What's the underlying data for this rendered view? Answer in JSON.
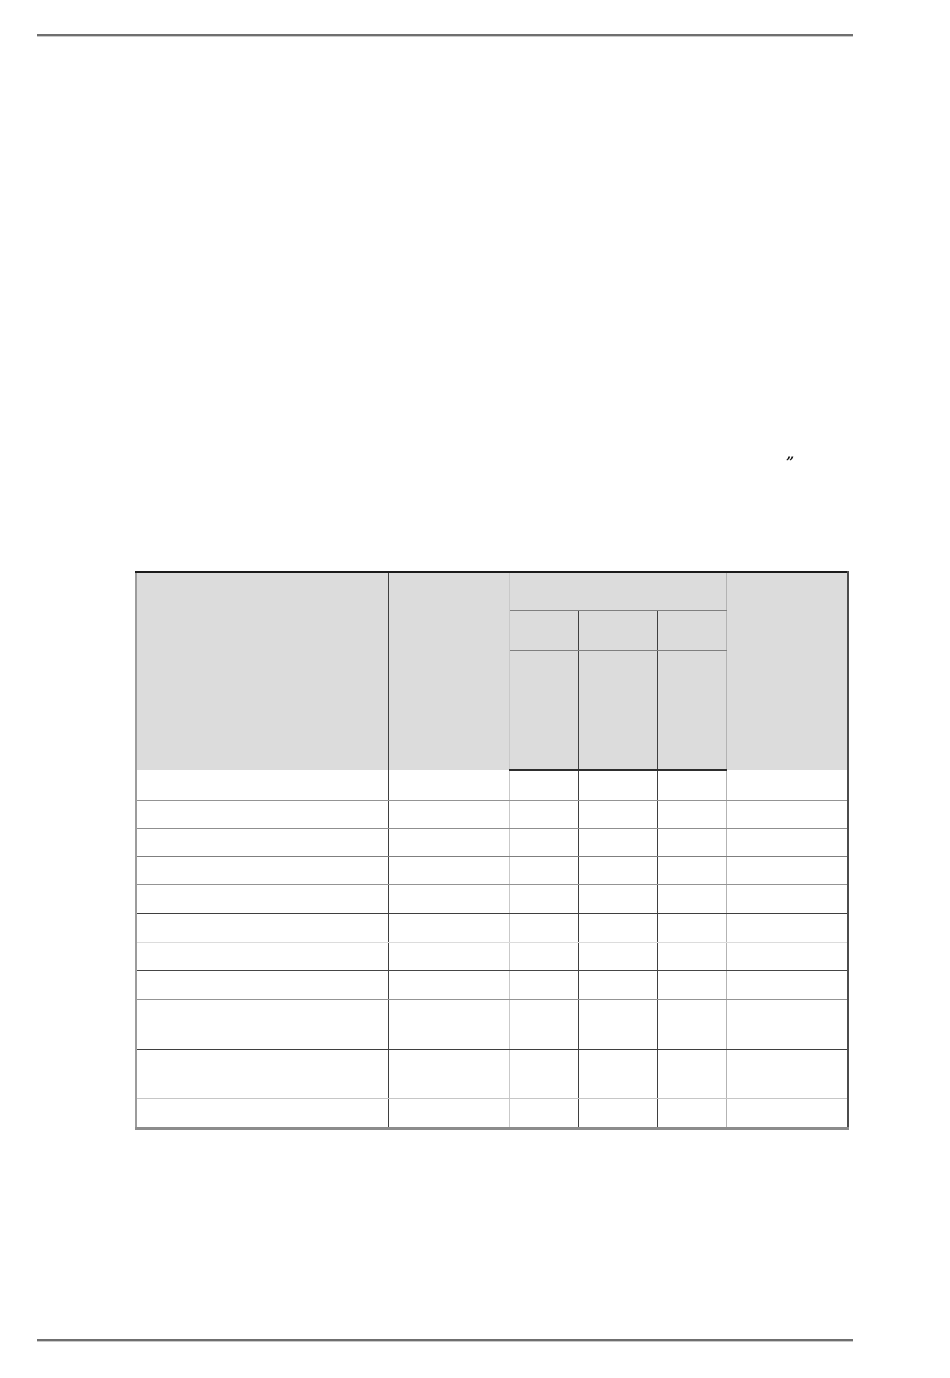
{
  "page": {
    "quote_mark": "”"
  },
  "table": {
    "header": {
      "col1": "",
      "col2": "",
      "group": "",
      "sub1": "",
      "sub2": "",
      "sub3": "",
      "col6": ""
    },
    "rows": [
      {
        "cells": [
          "",
          "",
          "",
          "",
          "",
          ""
        ]
      },
      {
        "cells": [
          "",
          "",
          "",
          "",
          "",
          ""
        ]
      },
      {
        "cells": [
          "",
          "",
          "",
          "",
          "",
          ""
        ]
      },
      {
        "cells": [
          "",
          "",
          "",
          "",
          "",
          ""
        ]
      },
      {
        "cells": [
          "",
          "",
          "",
          "",
          "",
          ""
        ]
      },
      {
        "cells": [
          "",
          "",
          "",
          "",
          "",
          ""
        ]
      },
      {
        "cells": [
          "",
          "",
          "",
          "",
          "",
          ""
        ]
      },
      {
        "cells": [
          "",
          "",
          "",
          "",
          "",
          ""
        ]
      },
      {
        "cells": [
          "",
          "",
          "",
          "",
          "",
          ""
        ]
      },
      {
        "cells": [
          "",
          "",
          "",
          "",
          "",
          ""
        ]
      },
      {
        "cells": [
          "",
          "",
          "",
          "",
          "",
          ""
        ]
      }
    ]
  }
}
